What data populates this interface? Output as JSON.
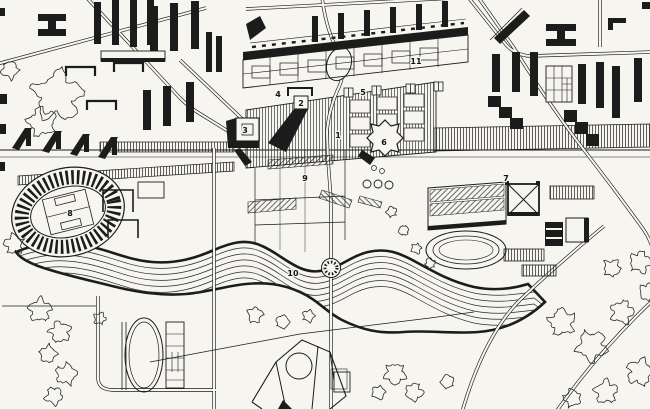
{
  "palette": {
    "paper": "#f6f5f0",
    "ink": "#1c1c1c"
  },
  "plan_labels": [
    {
      "text": "1",
      "x": 338,
      "y": 138
    },
    {
      "text": "2",
      "x": 301,
      "y": 106
    },
    {
      "text": "3",
      "x": 245,
      "y": 133
    },
    {
      "text": "4",
      "x": 278,
      "y": 97
    },
    {
      "text": "5",
      "x": 363,
      "y": 95
    },
    {
      "text": "6",
      "x": 384,
      "y": 145
    },
    {
      "text": "7",
      "x": 506,
      "y": 181
    },
    {
      "text": "8",
      "x": 70,
      "y": 216
    },
    {
      "text": "9",
      "x": 305,
      "y": 181
    },
    {
      "text": "10",
      "x": 293,
      "y": 276
    },
    {
      "text": "11",
      "x": 416,
      "y": 64
    }
  ],
  "features": [
    "housing-slab-blocks",
    "central-hall-plaza",
    "star-pavilion",
    "stadium",
    "river-with-contours",
    "esplanade-ramps",
    "sports-complex-pool",
    "roundabout-island",
    "tree-outlines",
    "road-network"
  ]
}
